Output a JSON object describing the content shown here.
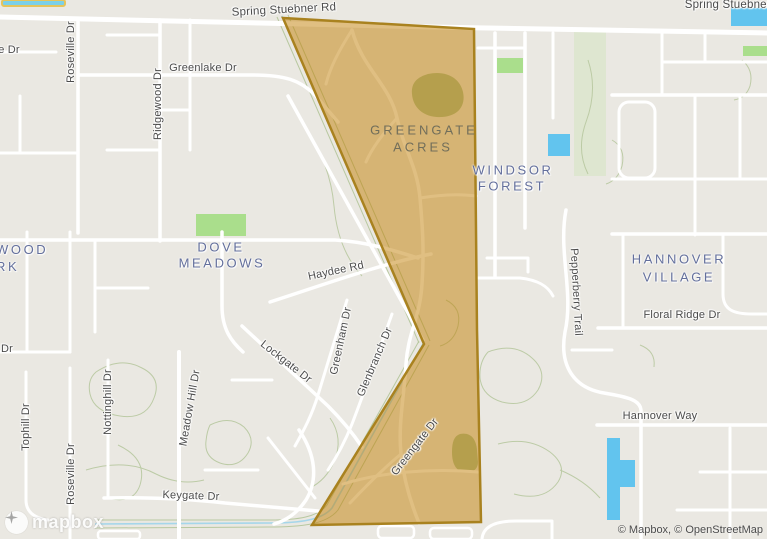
{
  "map": {
    "attribution": "© Mapbox, © OpenStreetMap",
    "logo_text": "mapbox"
  },
  "streets": {
    "spring_stuebner_rd": "Spring Stuebner Rd",
    "spring_stuebner_rd_right": "Spring Stuebner Rd",
    "greenlake_dr": "Greenlake Dr",
    "roseville_dr_north": "Roseville Dr",
    "ridgewood_dr": "Ridgewood Dr",
    "e_dr_fragment": "e Dr",
    "dr_fragment": "Dr",
    "haydee_rd": "Haydee Rd",
    "lockgate_dr": "Lockgate Dr",
    "greenham_dr": "Greenham Dr",
    "glenbranch_dr": "Glenbranch Dr",
    "meadow_hill_dr": "Meadow Hill Dr",
    "nottinghill_dr": "Nottinghill Dr",
    "tophill_dr": "Tophill Dr",
    "roseville_dr_south": "Roseville Dr",
    "keygate_dr": "Keygate Dr",
    "greengate_dr": "Greengate Dr",
    "pepperberry_trail": "Pepperberry Trail",
    "floral_ridge_dr": "Floral Ridge Dr",
    "hannover_way": "Hannover Way"
  },
  "areas": {
    "greengate_acres_line1": "GREENGATE",
    "greengate_acres_line2": "ACRES",
    "windsor_forest_line1": "WINDSOR",
    "windsor_forest_line2": "FOREST",
    "dove_meadows_line1": "DOVE",
    "dove_meadows_line2": "MEADOWS",
    "hannover_village_line1": "HANNOVER",
    "hannover_village_line2": "VILLAGE",
    "wood_park_line1": "WOOD",
    "wood_park_line2": "RK"
  },
  "colors": {
    "land": "#eae8e2",
    "road": "#ffffff",
    "water": "#62c4ee",
    "park_green": "#aade8c",
    "forest_band": "#dee6d0",
    "pond_sage": "#a9bf94",
    "contour_green": "#b8c8a0",
    "creek_blue": "#a5d6ea",
    "pool_outline_yellow": "#e5c45c",
    "polygon_fill": "rgba(193,128,5,0.5)",
    "polygon_stroke": "#a9821f",
    "street_label": "#4b4b4b",
    "area_label": "#636f9c",
    "area_label_tinted": "#716e5a"
  }
}
